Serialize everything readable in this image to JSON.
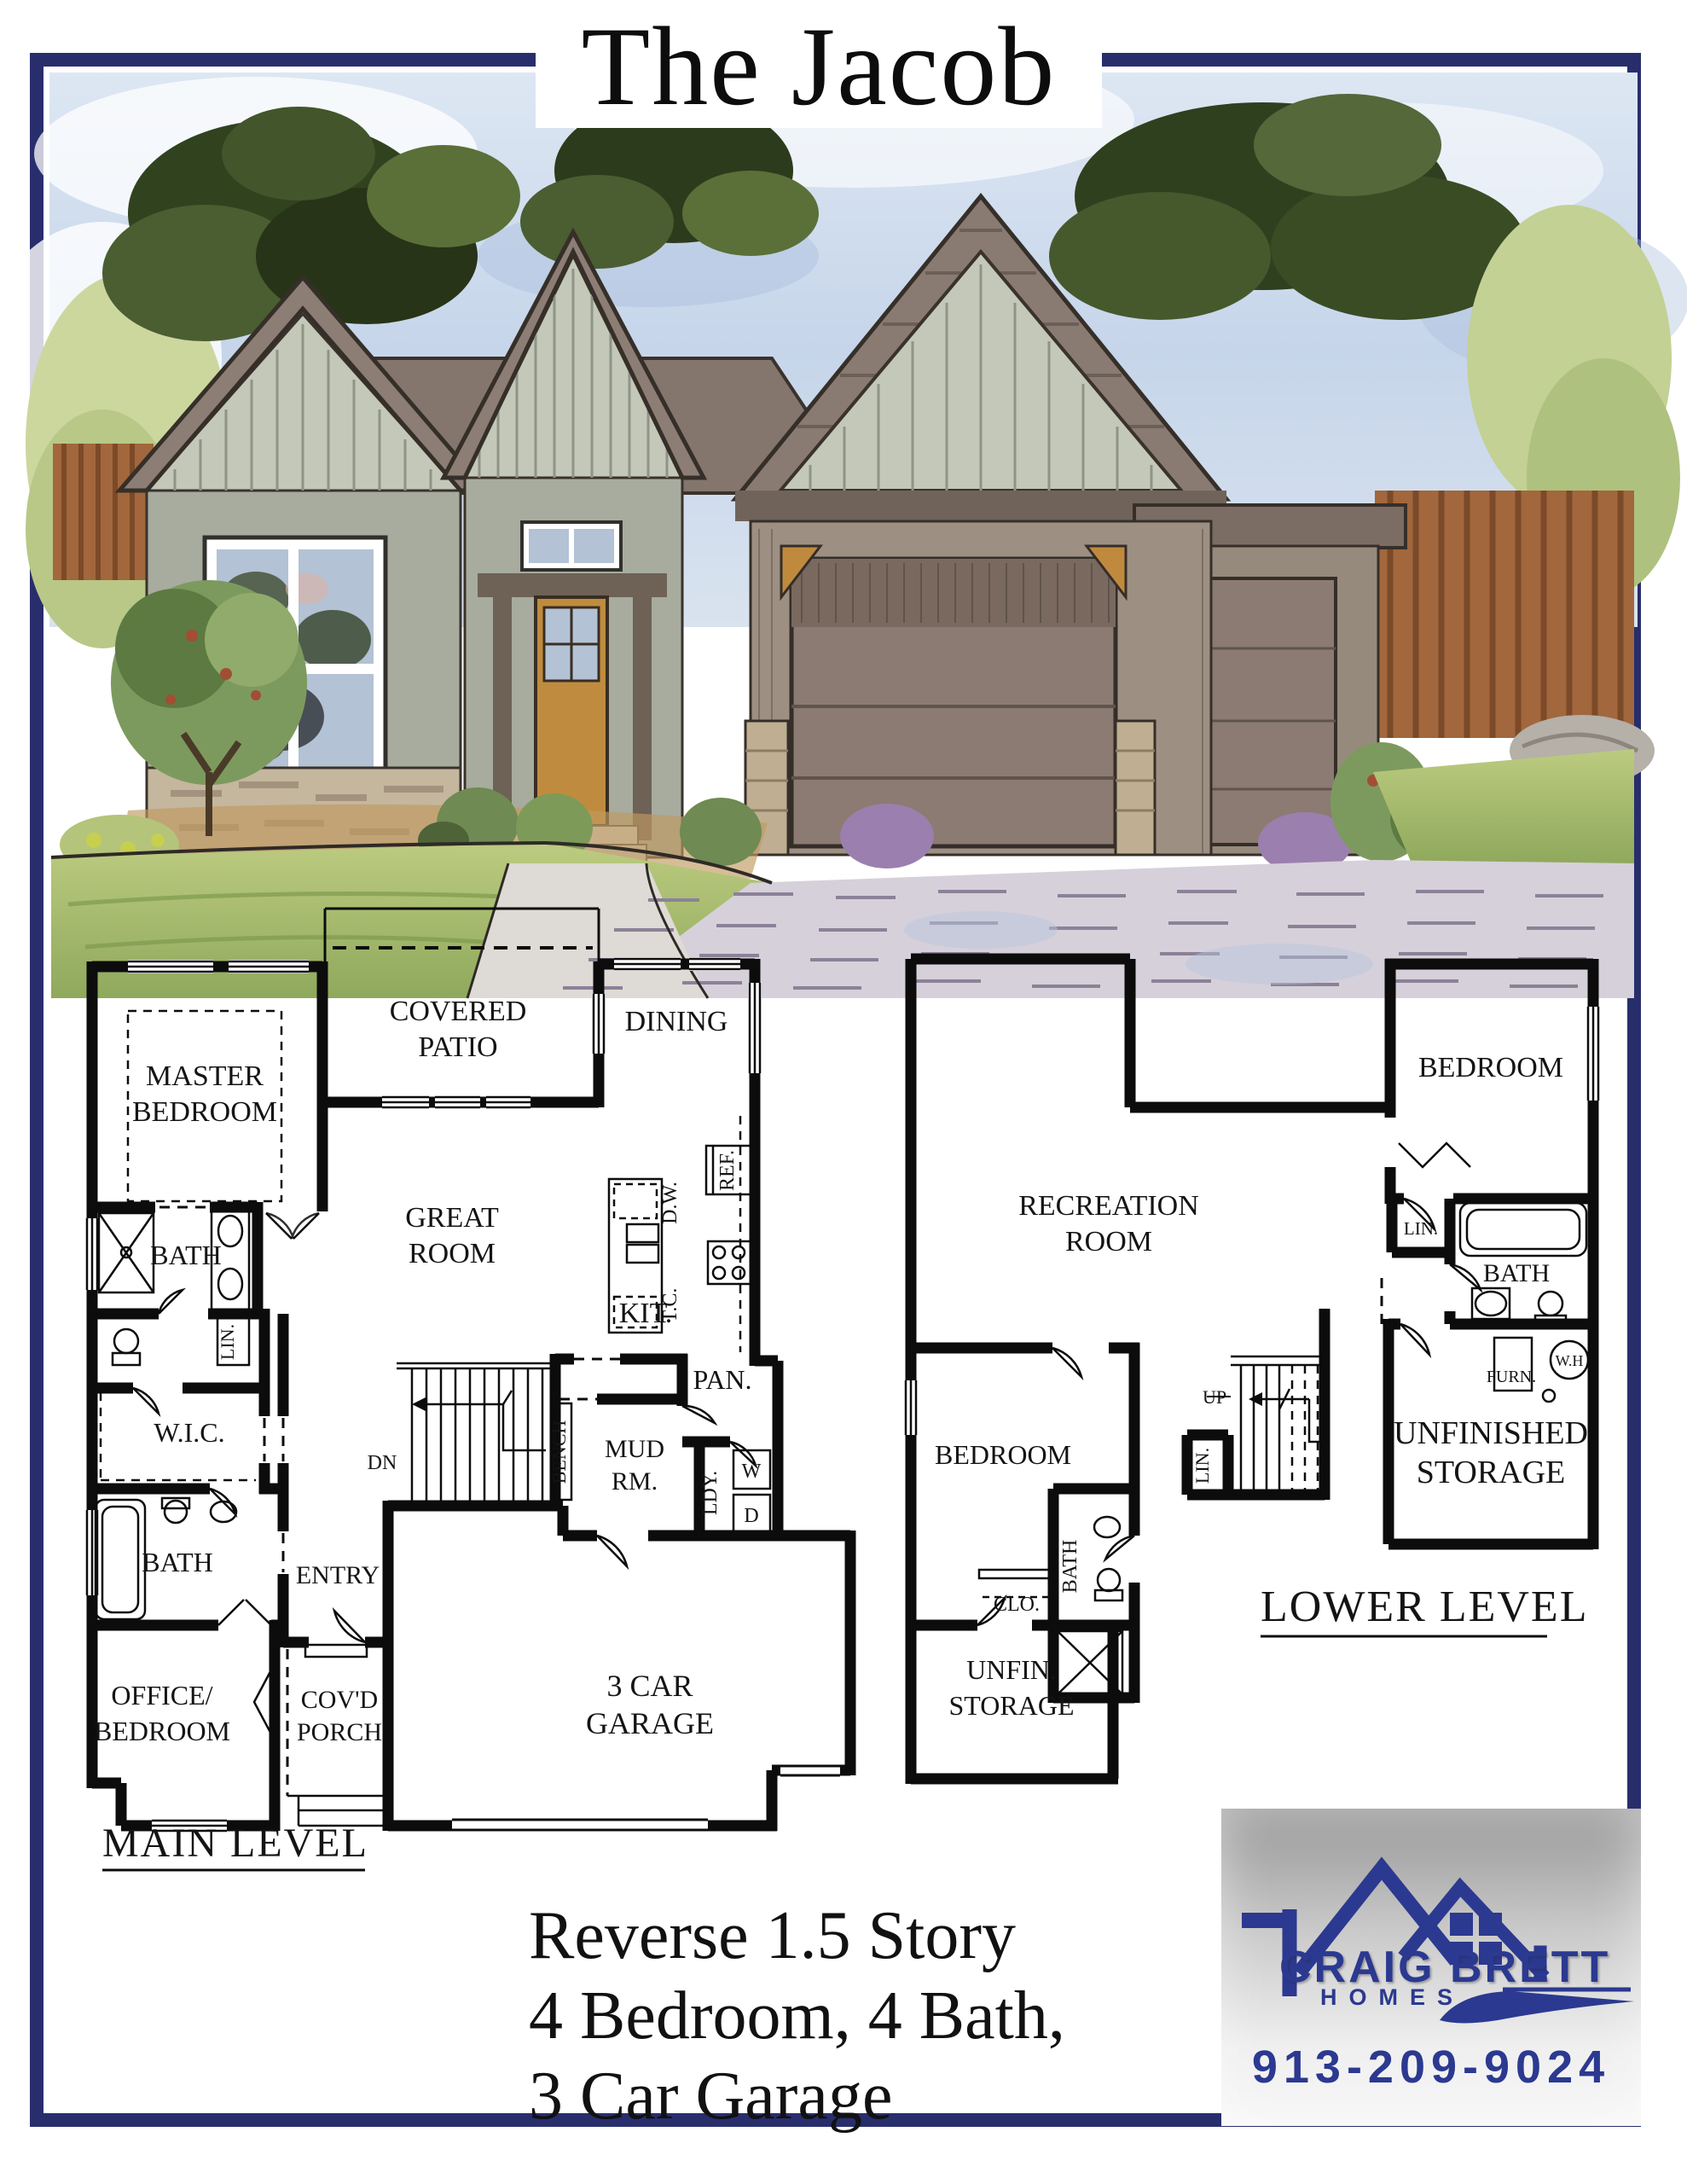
{
  "page": {
    "title": "The Jacob",
    "border_color": "#282e6c",
    "accent_navy": "#2b3990"
  },
  "main_level": {
    "heading": "MAIN LEVEL",
    "rooms": {
      "master_bedroom": [
        "MASTER",
        "BEDROOM"
      ],
      "covered_patio": [
        "COVERED",
        "PATIO"
      ],
      "dining": "DINING",
      "great_room": [
        "GREAT",
        "ROOM"
      ],
      "kitchen": "KIT.",
      "pantry": "PAN.",
      "fridge": "REF.",
      "dishwasher": "D.W.",
      "tall_cabinet": "T.C.",
      "master_bath": "BATH",
      "linen": "LIN.",
      "walk_in_closet": "W.I.C.",
      "bath2": "BATH",
      "entry": "ENTRY",
      "office": [
        "OFFICE/",
        "BEDROOM"
      ],
      "porch": [
        "COV'D",
        "PORCH"
      ],
      "mud_room": [
        "MUD",
        "RM."
      ],
      "bench": "BENCH",
      "laundry": "LDY.",
      "washer": "W",
      "dryer": "D",
      "stairs_dn": "DN",
      "garage": [
        "3 CAR",
        "GARAGE"
      ]
    }
  },
  "lower_level": {
    "heading": "LOWER LEVEL",
    "rooms": {
      "recreation": [
        "RECREATION",
        "ROOM"
      ],
      "bedroom_right": "BEDROOM",
      "linen_upper": "LIN.",
      "bath_right": "BATH",
      "furnace": "FURN.",
      "water_heater": "W.H",
      "stairs_up": "UP",
      "linen_stairs": "LIN.",
      "storage_right": [
        "UNFINISHED",
        "STORAGE"
      ],
      "bedroom_left": "BEDROOM",
      "closet": "CLO.",
      "bath_left": "BATH",
      "storage_left": [
        "UNFIN.",
        "STORAGE"
      ]
    }
  },
  "summary": {
    "line1": "Reverse 1.5 Story",
    "line2": "4 Bedroom, 4 Bath,",
    "line3": "3 Car Garage"
  },
  "logo": {
    "name": "CRAIG BRETT",
    "tagline": "HOMES",
    "phone": "913-209-9024"
  }
}
